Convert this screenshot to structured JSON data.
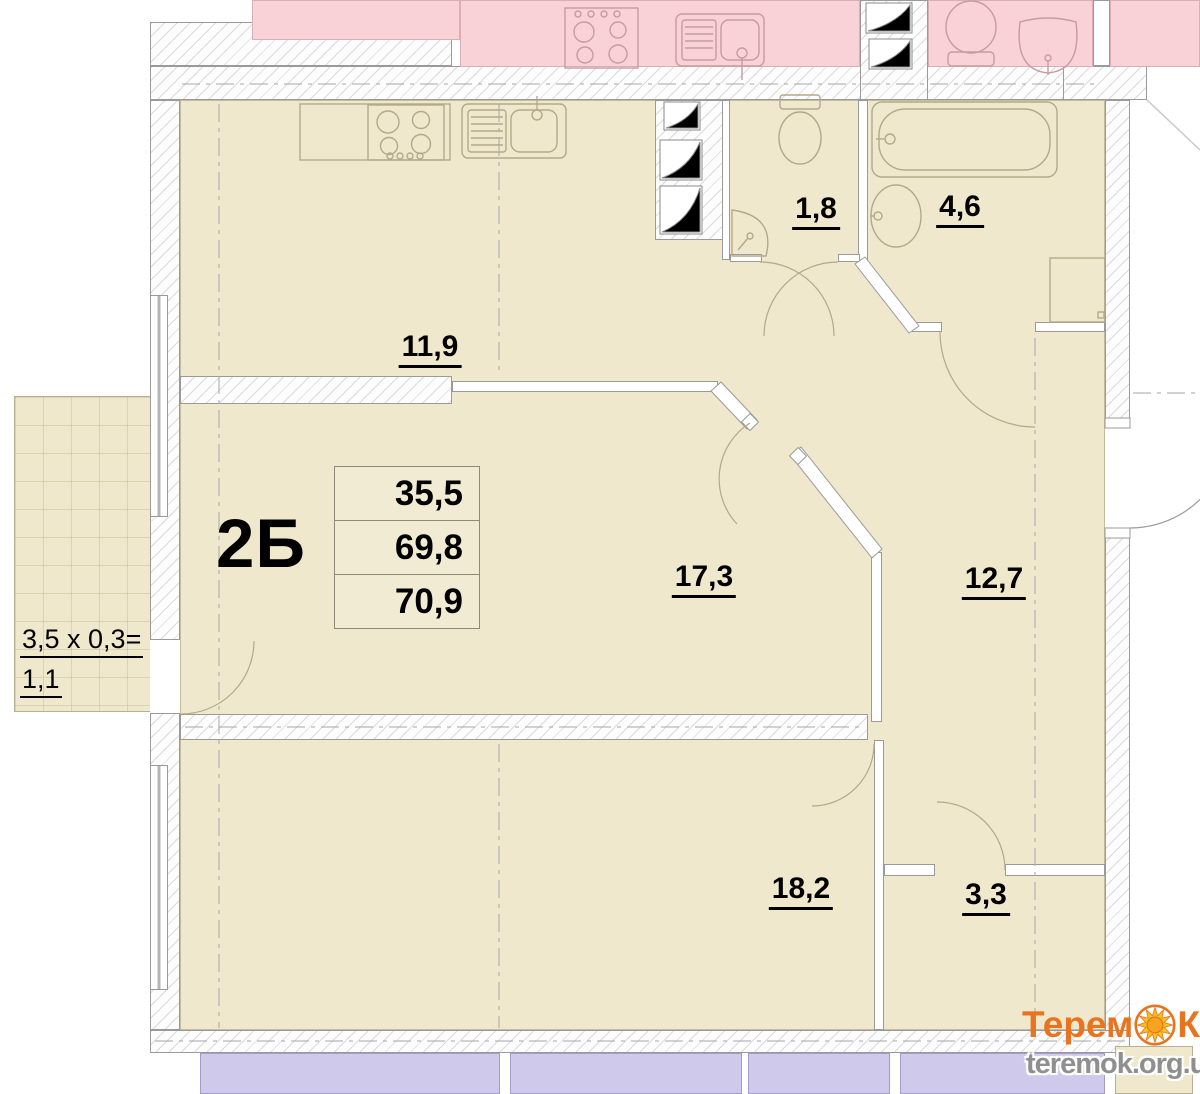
{
  "plan": {
    "apartment_label": "2Б",
    "areas_table": {
      "rows": [
        "35,5",
        "69,8",
        "70,9"
      ]
    },
    "rooms": [
      {
        "id": "kitchen",
        "area": "11,9"
      },
      {
        "id": "wc",
        "area": "1,8"
      },
      {
        "id": "bathroom",
        "area": "4,6"
      },
      {
        "id": "living-room",
        "area": "17,3"
      },
      {
        "id": "hallway",
        "area": "12,7"
      },
      {
        "id": "bedroom",
        "area": "18,2"
      },
      {
        "id": "storage",
        "area": "3,3"
      }
    ],
    "balcony": {
      "formula": "3,5 x 0,3=",
      "area": "1,1"
    }
  },
  "watermark": {
    "brand_part1": "Терем",
    "brand_part2": "К",
    "url": "teremok.org.ua"
  },
  "colors": {
    "room_fill": "#f0e8cc",
    "adjacent_fill": "#f8d2d6",
    "lower_balcony_fill": "#cfcaec",
    "wall_line": "#9a9a9a",
    "logo_orange": "#e87420",
    "sun_yellow": "#f7c31e"
  }
}
